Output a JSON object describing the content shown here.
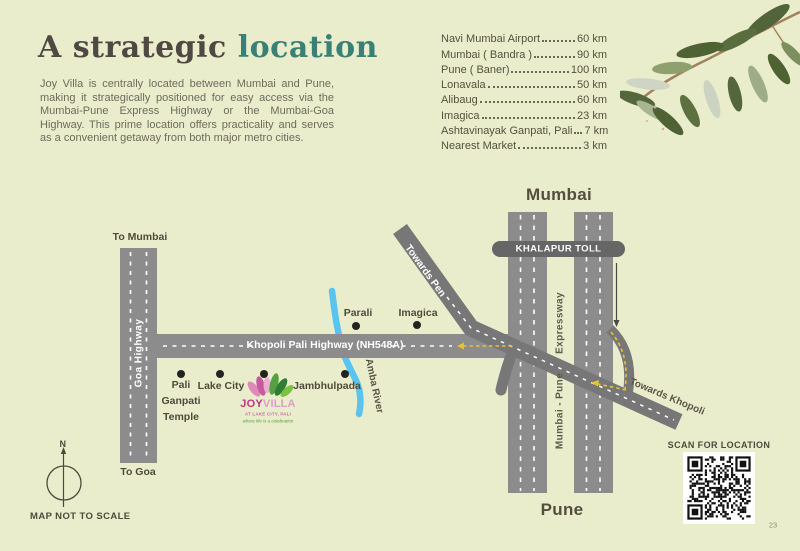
{
  "page": {
    "page_number": "23",
    "disclaimer": "MAP NOT TO SCALE"
  },
  "colors": {
    "background": "#e9edcc",
    "accent_teal": "#398077",
    "title_dark": "#504843",
    "road_gray": "#8c8c8c",
    "diagonal_road_gray": "#777777",
    "river_blue": "#58c4f1",
    "route_yellow": "#e6c42e",
    "logo_magenta": "#c13389",
    "logo_pink": "#db9ec6"
  },
  "header": {
    "title_dark": "A strategic",
    "title_accent": "location",
    "paragraph": "Joy Villa is centrally located between Mumbai and Pune, making it strategically positioned for easy access via the Mumbai-Pune Express Highway or the Mumbai-Goa Highway. This prime location offers practicality and serves as a convenient getaway from both major metro cities."
  },
  "distances": {
    "items": [
      {
        "label": "Navi Mumbai Airport",
        "value": "60 km"
      },
      {
        "label": "Mumbai ( Bandra )",
        "value": "90 km"
      },
      {
        "label": "Pune ( Baner)",
        "value": "100 km"
      },
      {
        "label": "Lonavala",
        "value": "50 km"
      },
      {
        "label": "Alibaug",
        "value": "60 km"
      },
      {
        "label": "Imagica",
        "value": "23 km"
      },
      {
        "label": "Ashtavinayak Ganpati, Pali",
        "value": "7 km"
      },
      {
        "label": "Nearest Market",
        "value": "3 km"
      }
    ]
  },
  "map": {
    "city_top": "Mumbai",
    "city_bottom": "Pune",
    "toll_label": "KHALAPUR TOLL",
    "roads": {
      "to_mumbai": "To Mumbai",
      "to_goa": "To Goa",
      "goa_highway": "Goa Highway",
      "khopoli_highway": "Khopoli Pali Highway (NH548A)",
      "expressway": "Expressway",
      "mumbai_pune": "Mumbai - Pune",
      "towards_pen": "Towards Pen",
      "towards_khopoli": "Towards Khopoli"
    },
    "river": "Amba River",
    "markers": {
      "pali_ganpati_temple": "Pali\nGanpati\nTemple",
      "lake_city": "Lake City",
      "jambhulpada": "Jambhulpada",
      "parali": "Parali",
      "imagica": "Imagica"
    },
    "logo": {
      "joy": "JOY",
      "villa": "VILLA",
      "tagline1": "AT LAKE CITY, PALI",
      "tagline2": "where life is a celebration"
    },
    "compass_north": "N"
  },
  "qr": {
    "caption": "SCAN FOR LOCATION"
  }
}
